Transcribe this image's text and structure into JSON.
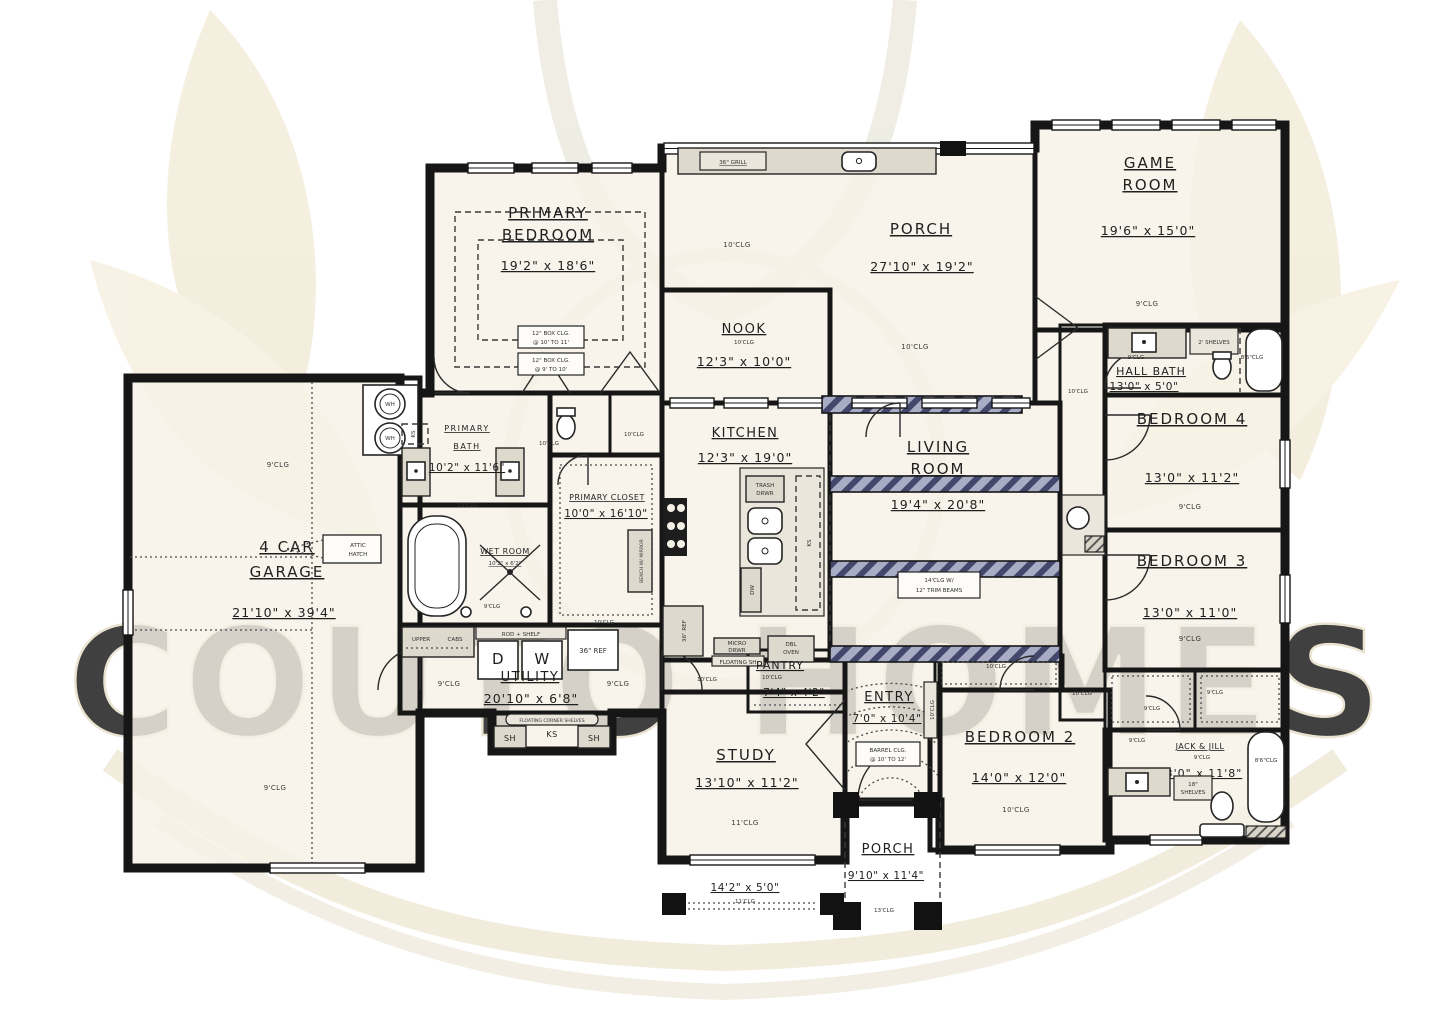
{
  "watermark": {
    "text": "COUTO HOMES"
  },
  "misc": {
    "clg9": "9'CLG",
    "clg10": "10'CLG",
    "clg86": "8'6\"CLG"
  },
  "rooms": {
    "garage": {
      "title1": "4 CAR",
      "title2": "GARAGE",
      "dims": "21'10\" x 39'4\"",
      "clg": "9'CLG",
      "attic1": "ATTIC",
      "attic2": "HATCH",
      "wh": "WH"
    },
    "primary_bedroom": {
      "title1": "PRIMARY",
      "title2": "BEDROOM",
      "dims": "19'2\" x 18'6\"",
      "box1a": "12\" BOX CLG.",
      "box1b": "@ 10' TO 11'",
      "box2a": "12\" BOX CLG.",
      "box2b": "@ 9' TO 10'"
    },
    "porch_top": {
      "title": "PORCH",
      "dims": "27'10\" x 19'2\"",
      "clg": "10'CLG",
      "grill": "36\" GRILL"
    },
    "nook": {
      "title": "NOOK",
      "clg": "10'CLG",
      "dims": "12'3\" x 10'0\""
    },
    "kitchen": {
      "title": "KITCHEN",
      "dims": "12'3\" x 19'0\"",
      "clg": "10'CLG",
      "trash1": "TRASH",
      "trash2": "DRWR",
      "ks": "KS",
      "dw": "DW",
      "ref": "36\" REF",
      "dbl1": "DBL",
      "dbl2": "OVEN",
      "micro1": "MICRO",
      "micro2": "DRWR",
      "floating": "FLOATING SH"
    },
    "living_room": {
      "title1": "LIVING",
      "title2": "ROOM",
      "dims": "19'4\" x 20'8\"",
      "note1": "14'CLG W/",
      "note2": "12\" TRIM BEAMS"
    },
    "game_room": {
      "title1": "GAME",
      "title2": "ROOM",
      "dims": "19'6\" x 15'0\"",
      "clg": "9'CLG"
    },
    "hall_bath": {
      "title": "HALL BATH",
      "dims": "13'0\" x 5'0\"",
      "clg": "9'CLG",
      "shelves": "2' SHELVES",
      "tub_clg": "8'6\"CLG"
    },
    "bedroom4": {
      "title": "BEDROOM 4",
      "dims": "13'0\" x 11'2\"",
      "clg": "9'CLG"
    },
    "bedroom3": {
      "title": "BEDROOM 3",
      "dims": "13'0\" x 11'0\"",
      "clg": "9'CLG"
    },
    "jack_jill": {
      "title": "JACK & JILL",
      "clg": "9'CLG",
      "dims": "13'0\" x 11'8\"",
      "tub_clg": "8'6\"CLG",
      "shelves1": "18\"",
      "shelves2": "SHELVES"
    },
    "bedroom2": {
      "title": "BEDROOM 2",
      "dims": "14'0\" x 12'0\"",
      "clg": "10'CLG"
    },
    "entry": {
      "title": "ENTRY",
      "dims": "7'0\" x 10'4\"",
      "barrel1": "BARREL CLG.",
      "barrel2": "@ 10' TO 12'"
    },
    "study": {
      "title": "STUDY",
      "dims": "13'10\" x 11'2\"",
      "clg": "11'CLG"
    },
    "study_porch": {
      "dims": "14'2\" x 5'0\"",
      "clg": "11'CLG"
    },
    "porch_bottom": {
      "title": "PORCH",
      "dims": "9'10\" x 11'4\"",
      "clg": "13'CLG"
    },
    "pantry": {
      "title": "PANTRY",
      "clg": "10'CLG",
      "dims": "7'4\" x 4'2\""
    },
    "utility": {
      "title": "UTILITY",
      "dims": "20'10\" x 6'8\"",
      "clg": "9'CLG",
      "upper": "UPPER",
      "cabs": "CABS",
      "rod_shelf": "ROD + SHELF",
      "d": "D",
      "w": "W",
      "ref": "36\" REF",
      "corner_shelves": "FLOATING CORNER SHELVES",
      "ks": "KS",
      "sh": "SH"
    },
    "primary_bath": {
      "title1": "PRIMARY",
      "title2": "BATH",
      "dims": "10'2\" x 11'6\"",
      "clg": "10'CLG",
      "ks": "KS"
    },
    "wet_room": {
      "title": "WET ROOM",
      "dims": "10'2\" x 6'2\"",
      "clg": "9'CLG"
    },
    "primary_closet": {
      "title": "PRIMARY CLOSET",
      "dims": "10'0\" x 16'10\"",
      "clg": "10'CLG",
      "bench": "BENCH W/ MIRROR"
    }
  }
}
